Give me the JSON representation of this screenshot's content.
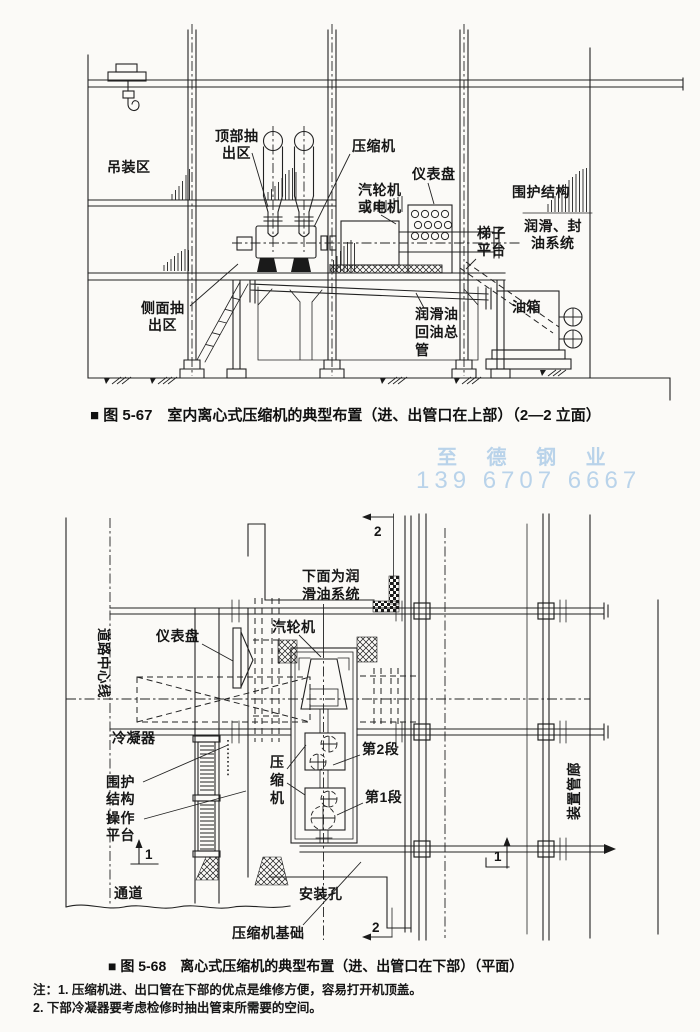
{
  "colors": {
    "ink": "#1a1a1a",
    "paper": "#fbfaf7",
    "watermark": "#b9d3ea"
  },
  "watermark": {
    "line1": "至 德 钢 业",
    "line2": "139 6707 6667"
  },
  "figure67": {
    "caption": "■ 图 5-67　室内离心式压缩机的典型布置（进、出管口在上部）（2—2 立面）",
    "labels": {
      "hoisting_area": "吊装区",
      "top_extraction_1": "顶部抽",
      "top_extraction_2": "出区",
      "compressor": "压缩机",
      "turbine_1": "汽轮机",
      "turbine_2": "或电机",
      "instrument_panel": "仪表盘",
      "enclosure": "围护结构",
      "lube_seal_1": "润滑、封",
      "lube_seal_2": "油系统",
      "ladder_platform_1": "梯子",
      "ladder_platform_2": "平台",
      "oil_tank": "油箱",
      "oil_return_1": "润滑油",
      "oil_return_2": "回油总",
      "oil_return_3": "管",
      "side_extraction_1": "侧面抽",
      "side_extraction_2": "出区"
    }
  },
  "figure68": {
    "caption": "■ 图 5-68　离心式压缩机的典型布置（进、出管口在下部）（平面）",
    "labels": {
      "lube_below_1": "下面为润",
      "lube_below_2": "滑油系统",
      "road_centerline": "道路中心线",
      "instrument_panel": "仪表盘",
      "steam_turbine": "汽轮机",
      "condenser": "冷凝器",
      "enclosure_1": "围护",
      "enclosure_2": "结构",
      "compressor_1": "压",
      "compressor_2": "缩",
      "compressor_3": "机",
      "stage2": "第2段",
      "stage1": "第1段",
      "operating_platform_1": "操作",
      "operating_platform_2": "平台",
      "passage": "通道",
      "installation_hole": "安装孔",
      "compressor_foundation": "压缩机基础",
      "pipe_rack": "装置管廊",
      "section_1": "1",
      "section_2": "2"
    }
  },
  "notes": {
    "line1": "注：1. 压缩机进、出口管在下部的优点是维修方便，容易打开机顶盖。",
    "line2": "2. 下部冷凝器要考虑检修时抽出管束所需要的空间。"
  }
}
